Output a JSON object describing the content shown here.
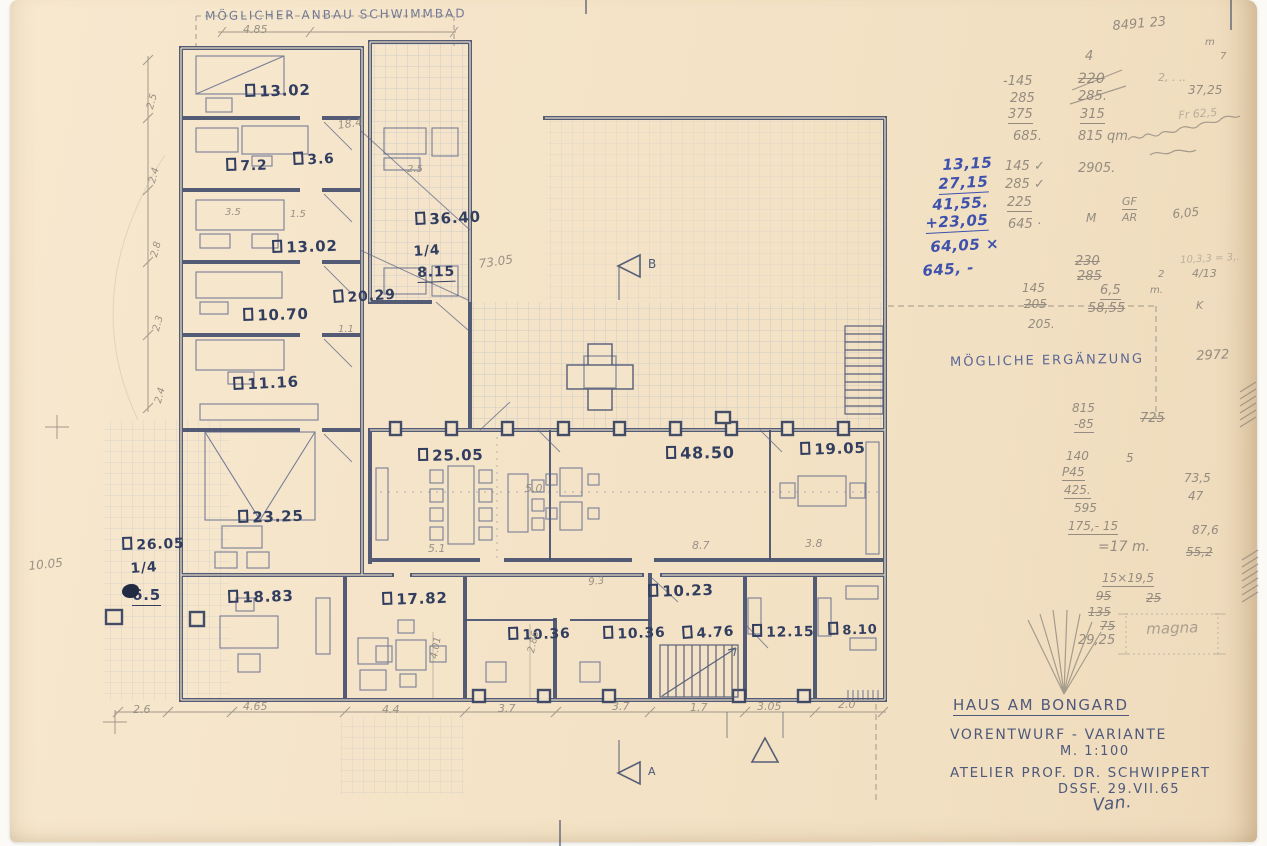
{
  "drawing": {
    "extension_note": "MÖGLICHER ANBAU SCHWIMMBAD",
    "ergaenzung_note": "MÖGLICHE ERGÄNZUNG"
  },
  "rooms": {
    "r1": "13.02",
    "r2": "7.2",
    "r3": "3.6",
    "r4": "13.02",
    "r5": "36.40",
    "r5a": "1/4",
    "r5b": "8.15",
    "r6": "20.29",
    "r7": "10.70",
    "r8": "11.16",
    "r9": "23.25",
    "r10": "26.05",
    "r10a": "1/4",
    "r10b": "6.5",
    "r11": "25.05",
    "r12": "48.50",
    "r13": "19.05",
    "r14": "18.83",
    "r15": "17.82",
    "r16": "10.23",
    "r17": "10.36",
    "r18": "10.36",
    "r19": "4.76",
    "r20": "12.15",
    "r21": "8.10"
  },
  "dims": {
    "top": "4.85",
    "d184": "18.4",
    "d25": "2.5",
    "d35": "3.5",
    "d15": "1.5",
    "left1": "2.5",
    "left2": "2.4",
    "left3": "2.8",
    "left4": "2.3",
    "left5": "2.4",
    "d11": "1.1",
    "d7305": "73.05",
    "d50": "5.0",
    "d51": "5.1",
    "d87": "8.7",
    "d38": "3.8",
    "d93": "9.3",
    "d286": "2.86",
    "d401": "4.01",
    "d1005": "10.05",
    "b1": "2.6",
    "b2": "4.65",
    "b3": "4.4",
    "b4": "3.7",
    "b5": "3.7",
    "b6": "1.7",
    "b7": "3.05",
    "b8": "2.0"
  },
  "sections": {
    "a": "A",
    "b": "B"
  },
  "ink_sums": {
    "s1": "13,15",
    "s2": "27,15",
    "s3": "41,55.",
    "s4": "+23,05",
    "s5": "64,05 ×",
    "s6": "645, -"
  },
  "pencil": {
    "top": {
      "serial": "8491 23",
      "four": "4",
      "m": "m",
      "seven": "7",
      "dots": "2, . ..",
      "v3725": "37,25",
      "fr": "Fr 62,5"
    },
    "colA": {
      "a1": "-145",
      "a2": "285",
      "a3": "375",
      "a4": "685."
    },
    "colB": {
      "b1": "220",
      "b2": "285.",
      "b3": "315",
      "b4": "815 qm"
    },
    "colC": {
      "c1": "145 ✓",
      "c2": "285 ✓",
      "c3": "225",
      "c4": "645 ·",
      "c5": "2905.",
      "m": "M",
      "gf": "GF",
      "ar": "AR",
      "v605": "6,05"
    },
    "mid": {
      "m1": "230",
      "m2": "285",
      "m3": "6,5",
      "m4": "58,55",
      "m5": "145",
      "m6": "205",
      "m7": "205.",
      "m8": "10,3,3 = 3,.",
      "m9": "2",
      "m10": "m.",
      "m11": "4/13",
      "k": "K",
      "v2972": "2972"
    },
    "erg": {
      "e1": "815",
      "e2": "-85",
      "e3": "725"
    },
    "colD": {
      "d1": "140",
      "d2": "P45",
      "d3": "425.",
      "d4": "595",
      "d5": "175,- 15",
      "d6": "=17 m.",
      "d7": "5",
      "d8": "73,5",
      "d9": "47",
      "d10": "87,6",
      "d11": "55,2",
      "d12": "15×19,5",
      "d13": "95",
      "d14": "25",
      "d15": "135",
      "d16": "75",
      "d17": "29,25"
    },
    "box_word": "magna"
  },
  "title_block": {
    "project": "HAUS AM BONGARD",
    "phase": "VORENTWURF - VARIANTE",
    "scale": "M. 1:100",
    "atelier": "ATELIER PROF. DR. SCHWIPPERT",
    "date": "DSSF. 29.VII.65",
    "signature": "Van."
  }
}
